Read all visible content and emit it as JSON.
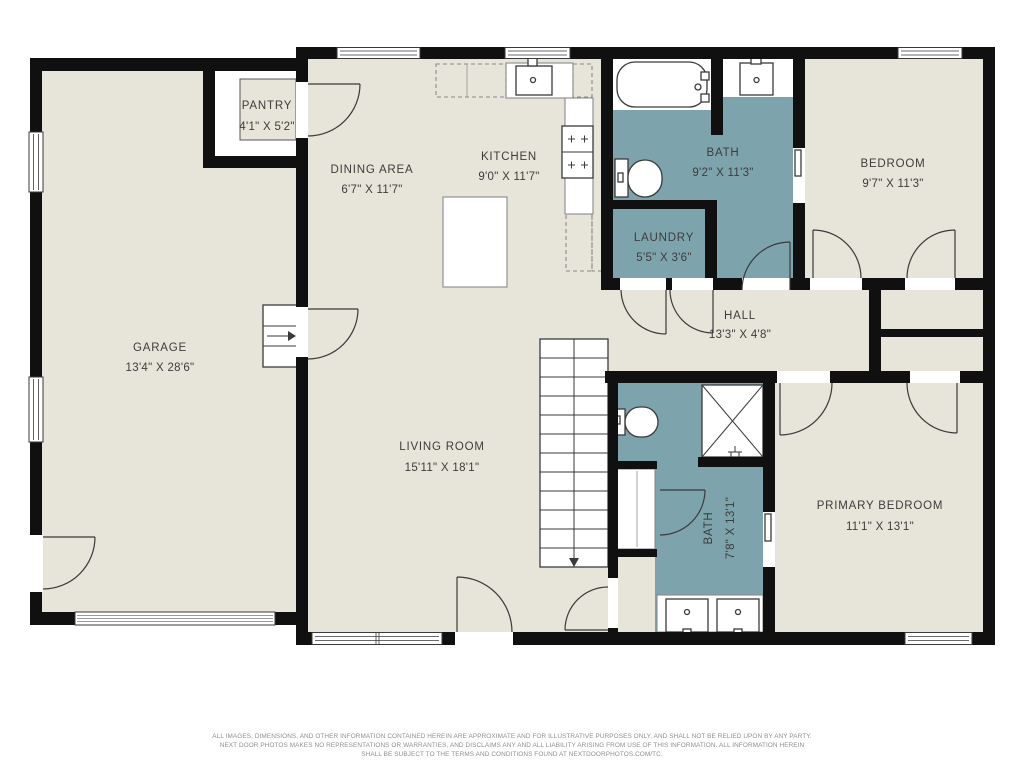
{
  "colors": {
    "floor": "#e7e5d9",
    "bath": "#7da4ad",
    "wall": "#101010",
    "line": "#3a3a3a",
    "counter": "#8a8a8a",
    "text": "#3c3c3c",
    "muted": "#8f8f8f"
  },
  "rooms": [
    {
      "id": "garage",
      "name": "GARAGE",
      "dims": "13'4\" X 28'6\""
    },
    {
      "id": "pantry",
      "name": "PANTRY",
      "dims": "4'1\" X 5'2\""
    },
    {
      "id": "dining-area",
      "name": "DINING AREA",
      "dims": "6'7\" X 11'7\""
    },
    {
      "id": "kitchen",
      "name": "KITCHEN",
      "dims": "9'0\" X 11'7\""
    },
    {
      "id": "bath",
      "name": "BATH",
      "dims": "9'2\" X 11'3\""
    },
    {
      "id": "laundry",
      "name": "LAUNDRY",
      "dims": "5'5\" X 3'6\""
    },
    {
      "id": "bedroom",
      "name": "BEDROOM",
      "dims": "9'7\" X 11'3\""
    },
    {
      "id": "hall",
      "name": "HALL",
      "dims": "13'3\" X 4'8\""
    },
    {
      "id": "living-room",
      "name": "LIVING ROOM",
      "dims": "15'11\" X 18'1\""
    },
    {
      "id": "bath-2",
      "name": "BATH",
      "dims": "7'8\" X 13'1\""
    },
    {
      "id": "primary-bedroom",
      "name": "PRIMARY BEDROOM",
      "dims": "11'1\" X 13'1\""
    }
  ],
  "footer": {
    "line1": "ALL IMAGES, DIMENSIONS, AND OTHER INFORMATION CONTAINED HEREIN ARE APPROXIMATE AND FOR ILLUSTRATIVE PURPOSES ONLY, AND SHALL NOT BE RELIED UPON BY ANY PARTY.",
    "line2": "NEXT DOOR PHOTOS MAKES NO REPRESENTATIONS OR WARRANTIES, AND DISCLAIMS ANY AND ALL LIABILITY ARISING FROM USE OF THIS INFORMATION. ALL INFORMATION HEREIN",
    "line3": "SHALL BE SUBJECT TO THE TERMS AND CONDITIONS FOUND AT NEXTDOORPHOTOS.COM/TC."
  }
}
